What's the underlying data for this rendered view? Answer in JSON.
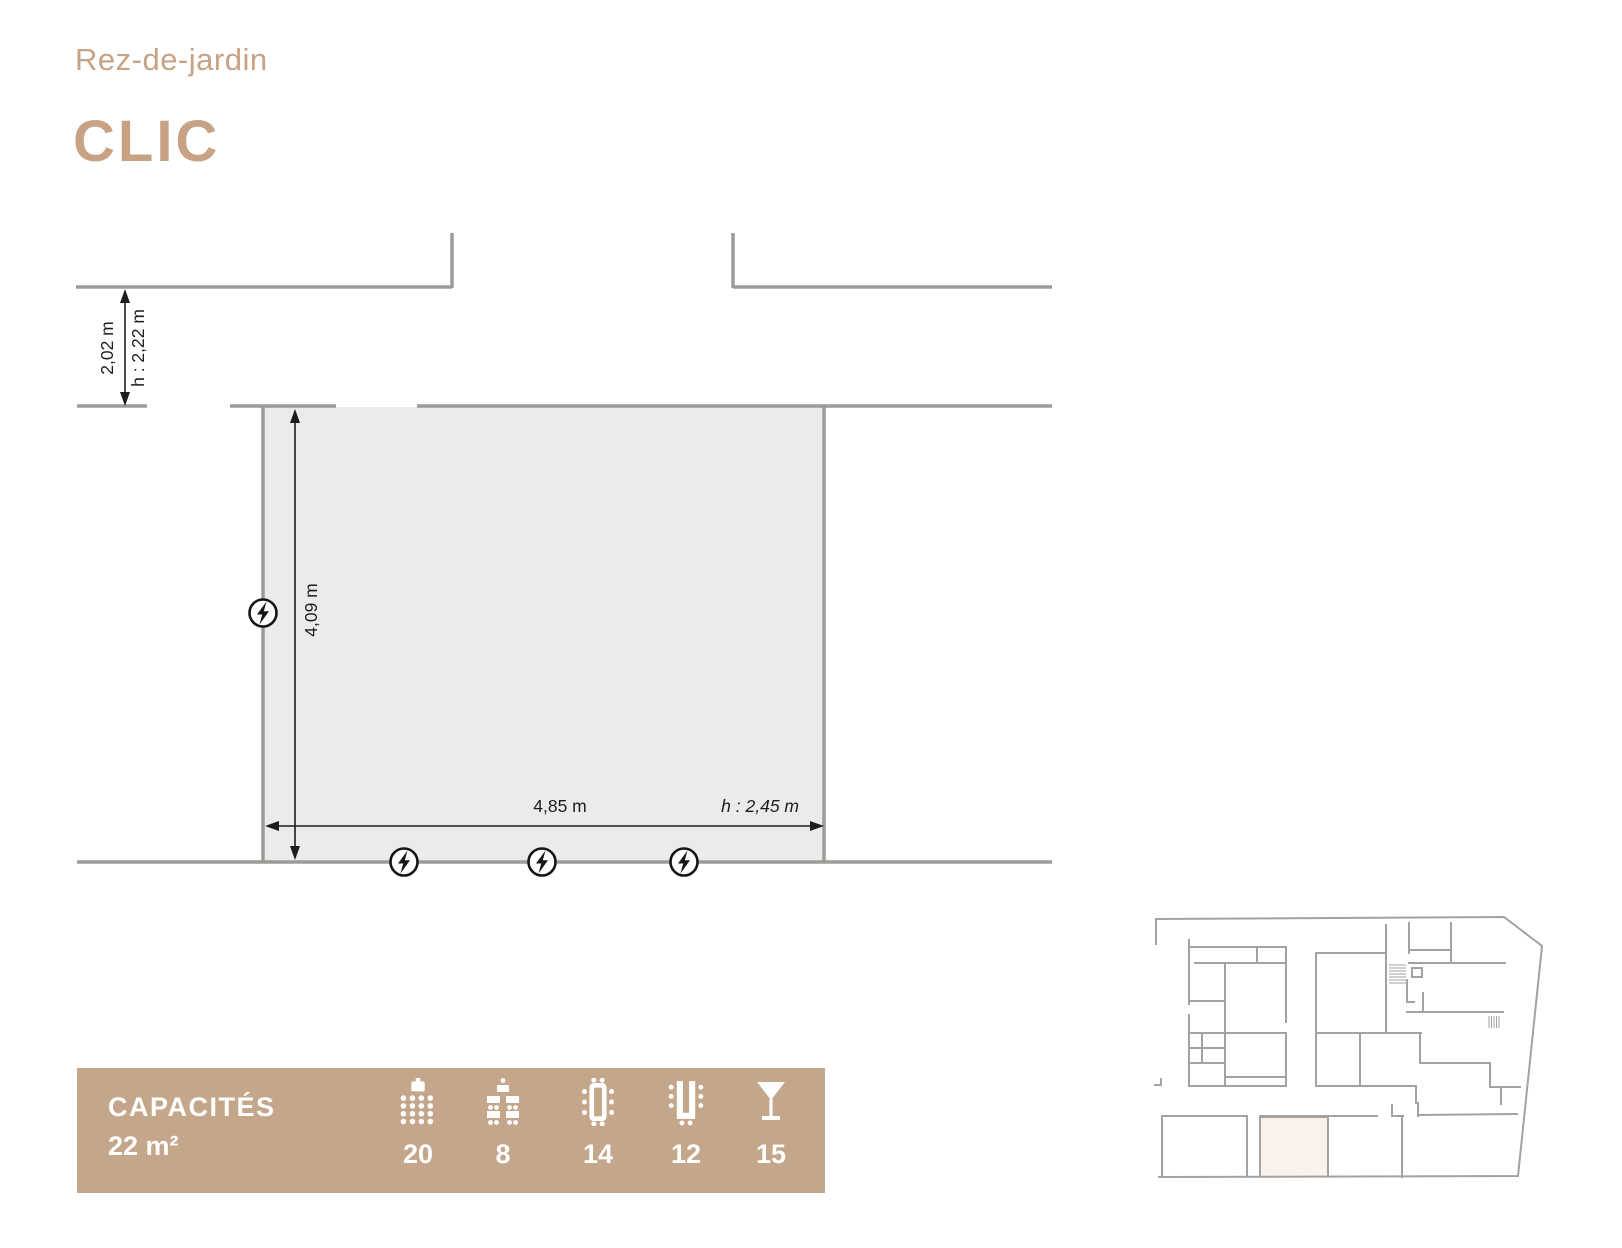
{
  "header": {
    "floor_label": "Rez-de-jardin",
    "room_name": "CLIC"
  },
  "plan": {
    "corridor_width_label": "2,02 m",
    "corridor_height_label": "h : 2,22 m",
    "room_depth_label": "4,09 m",
    "room_width_label": "4,85 m",
    "room_ceiling_label": "h : 2,45 m",
    "outlet_count": 4
  },
  "capacities": {
    "title": "CAPACITÉS",
    "area": "22 m²",
    "layouts": [
      {
        "name": "theatre",
        "icon": "theater-icon",
        "value": "20"
      },
      {
        "name": "classroom",
        "icon": "classroom-icon",
        "value": "8"
      },
      {
        "name": "boardroom",
        "icon": "boardroom-icon",
        "value": "14"
      },
      {
        "name": "u-shape",
        "icon": "ushape-icon",
        "value": "12"
      },
      {
        "name": "cocktail",
        "icon": "cocktail-icon",
        "value": "15"
      }
    ]
  },
  "colors": {
    "accent": "#c7a285",
    "bar_background": "#c4a68a",
    "wall_grey": "#9b9b97",
    "room_fill": "#ebebeb",
    "dimension_ink": "#1d1d1b",
    "minimap_wall": "#a3a29e",
    "minimap_highlight": "#faf1ea"
  }
}
